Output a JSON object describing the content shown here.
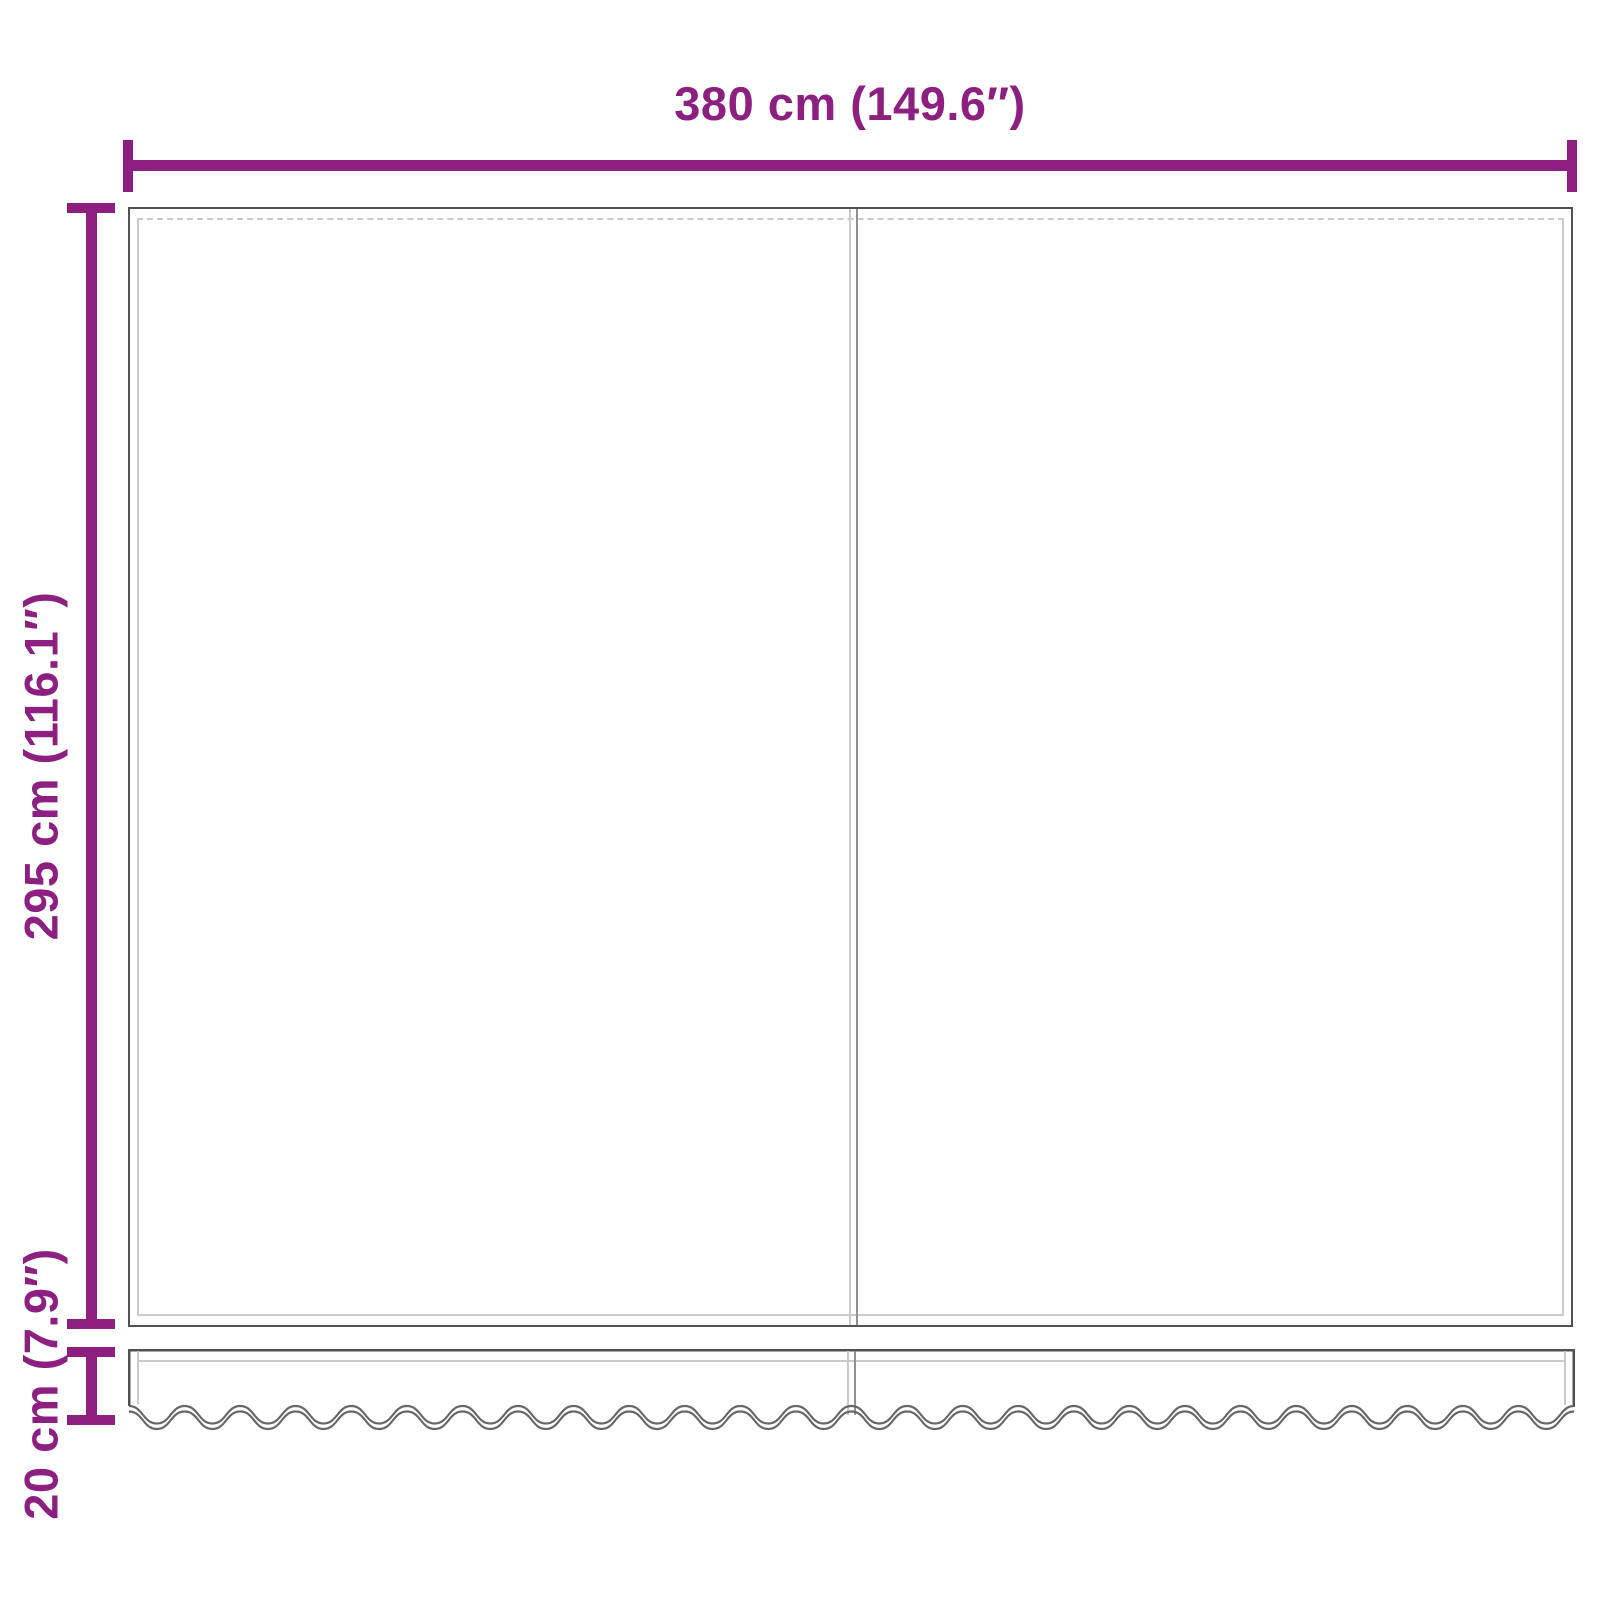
{
  "page": {
    "background": "#FFFFFF"
  },
  "colors": {
    "accent_purple": "#8C1F7F",
    "panel_outline": "#515254",
    "stitch_gray": "#C9CACB",
    "seam_gray": "#8F9093",
    "wave_gray": "#66676A"
  },
  "dimensions": {
    "width": {
      "label": "380 cm (149.6″)"
    },
    "height": {
      "label": "295 cm (116.1″)"
    },
    "valance_height": {
      "label": "20 cm (7.9″)"
    }
  }
}
